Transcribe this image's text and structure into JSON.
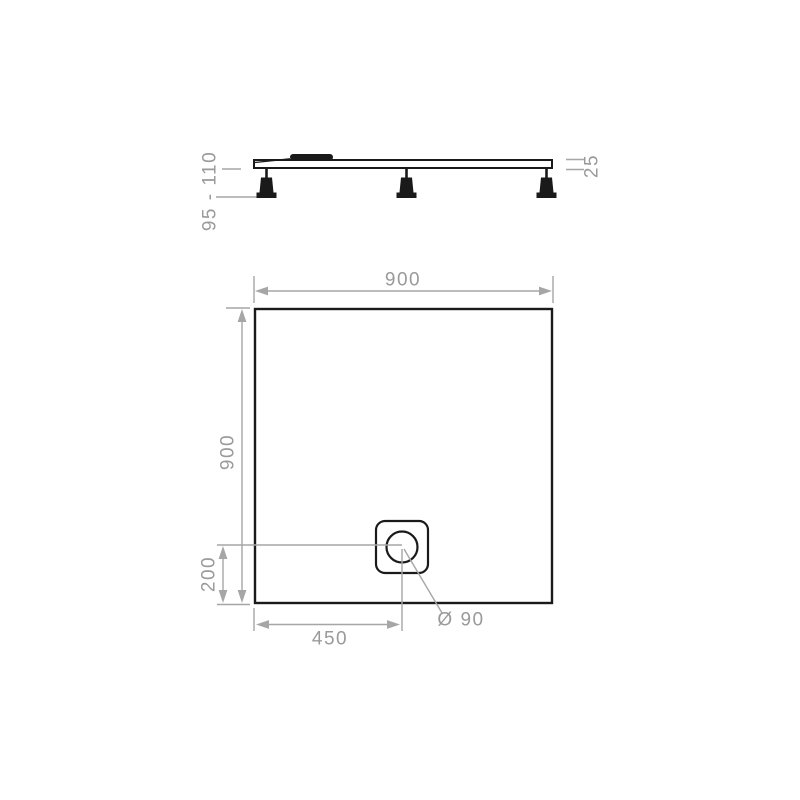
{
  "canvas": {
    "background": "#ffffff"
  },
  "side_view": {
    "description": "shower-tray side elevation with adjustable feet and waste outlet",
    "labels": {
      "foot_height_range": "95 - 110",
      "tray_thickness": "25"
    }
  },
  "plan_view": {
    "description": "shower-tray plan view with offset corner drain",
    "labels": {
      "overall_width": "900",
      "overall_depth": "900",
      "drain_center_from_bottom": "200",
      "drain_center_from_left": "450",
      "drain_diameter": "Ø 90"
    }
  },
  "colors": {
    "outline": "#1a1a1a",
    "dimension_line": "#a6a6a6",
    "dimension_text": "#9a9a9a",
    "background": "#ffffff"
  }
}
